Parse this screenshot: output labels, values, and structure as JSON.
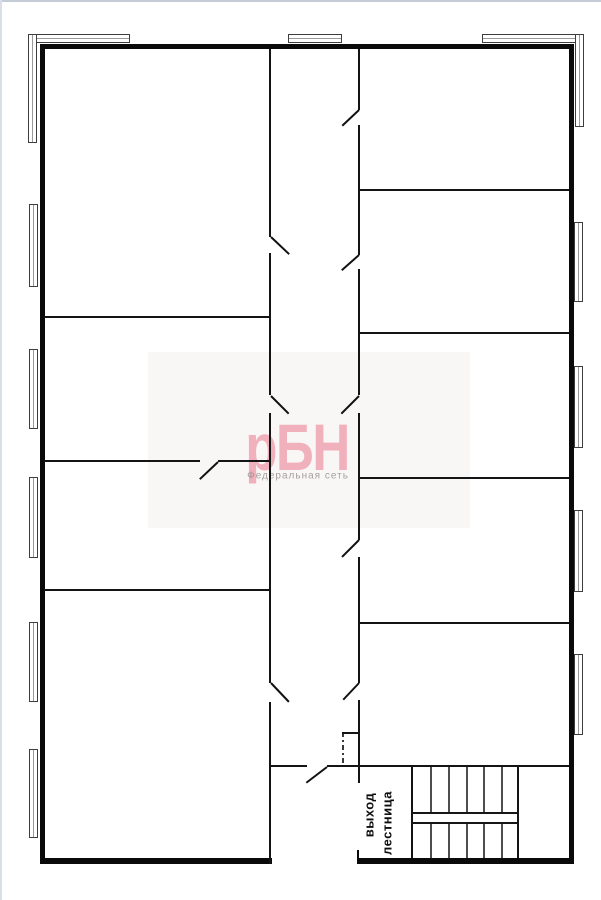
{
  "labels": {
    "exit": "выход",
    "stairs": "лестница"
  },
  "watermark": {
    "brand": "рБН",
    "subtitle": "Федеральная сеть",
    "brand_color": "#efa4b2",
    "subtitle_color": "#949091"
  },
  "colors": {
    "wall": "#0a0a0a",
    "thin_wall": "#141414",
    "step": "#4e4e4e",
    "window_frame": "#3e3e3e",
    "chrome_edge": "#c6ccd7"
  },
  "plan": {
    "width": 601,
    "height": 900,
    "walls_thick": [
      {
        "x": 41,
        "y": 44,
        "w": 533,
        "h": 5
      },
      {
        "x": 40,
        "y": 44,
        "w": 5,
        "h": 820
      },
      {
        "x": 569,
        "y": 44,
        "w": 5,
        "h": 820
      },
      {
        "x": 40,
        "y": 858,
        "w": 232,
        "h": 6
      },
      {
        "x": 357,
        "y": 858,
        "w": 217,
        "h": 6
      },
      {
        "x": 357,
        "y": 850,
        "w": 2,
        "h": 8
      }
    ],
    "walls_thin": [
      {
        "x": 269,
        "y": 49,
        "w": 2,
        "h": 188
      },
      {
        "x": 269,
        "y": 253,
        "w": 2,
        "h": 142
      },
      {
        "x": 269,
        "y": 413,
        "w": 2,
        "h": 270
      },
      {
        "x": 269,
        "y": 702,
        "w": 2,
        "h": 162
      },
      {
        "x": 358,
        "y": 49,
        "w": 2,
        "h": 61
      },
      {
        "x": 358,
        "y": 125,
        "w": 2,
        "h": 130
      },
      {
        "x": 358,
        "y": 269,
        "w": 2,
        "h": 126
      },
      {
        "x": 358,
        "y": 413,
        "w": 2,
        "h": 127
      },
      {
        "x": 358,
        "y": 557,
        "w": 2,
        "h": 126
      },
      {
        "x": 358,
        "y": 700,
        "w": 2,
        "h": 83
      },
      {
        "x": 44,
        "y": 316,
        "w": 225,
        "h": 2
      },
      {
        "x": 44,
        "y": 460,
        "w": 156,
        "h": 2
      },
      {
        "x": 218,
        "y": 460,
        "w": 51,
        "h": 2
      },
      {
        "x": 44,
        "y": 589,
        "w": 225,
        "h": 2
      },
      {
        "x": 360,
        "y": 189,
        "w": 209,
        "h": 2
      },
      {
        "x": 360,
        "y": 332,
        "w": 209,
        "h": 2
      },
      {
        "x": 360,
        "y": 477,
        "w": 209,
        "h": 2
      },
      {
        "x": 360,
        "y": 622,
        "w": 209,
        "h": 2
      },
      {
        "x": 271,
        "y": 765,
        "w": 36,
        "h": 2
      },
      {
        "x": 327,
        "y": 765,
        "w": 242,
        "h": 2
      },
      {
        "x": 411,
        "y": 766,
        "w": 2,
        "h": 92
      },
      {
        "x": 517,
        "y": 766,
        "w": 2,
        "h": 92
      },
      {
        "x": 342,
        "y": 732,
        "w": 17,
        "h": 2
      }
    ],
    "doors": [
      {
        "x1": 271,
        "y1": 237,
        "x2": 289,
        "y2": 254
      },
      {
        "x1": 271,
        "y1": 396,
        "x2": 289,
        "y2": 414
      },
      {
        "x1": 271,
        "y1": 683,
        "x2": 289,
        "y2": 702
      },
      {
        "x1": 359,
        "y1": 110,
        "x2": 342,
        "y2": 126
      },
      {
        "x1": 359,
        "y1": 255,
        "x2": 342,
        "y2": 270
      },
      {
        "x1": 359,
        "y1": 396,
        "x2": 341,
        "y2": 414
      },
      {
        "x1": 359,
        "y1": 540,
        "x2": 342,
        "y2": 557
      },
      {
        "x1": 359,
        "y1": 683,
        "x2": 343,
        "y2": 700
      },
      {
        "x1": 218,
        "y1": 462,
        "x2": 200,
        "y2": 479
      },
      {
        "x1": 327,
        "y1": 767,
        "x2": 306,
        "y2": 783
      }
    ],
    "windows_h": [
      {
        "x": 28,
        "y": 34,
        "w": 102,
        "h": 9
      },
      {
        "x": 288,
        "y": 34,
        "w": 54,
        "h": 9
      },
      {
        "x": 482,
        "y": 34,
        "w": 102,
        "h": 9
      }
    ],
    "windows_v": [
      {
        "x": 28,
        "y": 34,
        "w": 9,
        "h": 109
      },
      {
        "x": 575,
        "y": 34,
        "w": 9,
        "h": 93
      },
      {
        "x": 29,
        "y": 204,
        "w": 9,
        "h": 83
      },
      {
        "x": 29,
        "y": 349,
        "w": 9,
        "h": 80
      },
      {
        "x": 29,
        "y": 477,
        "w": 9,
        "h": 81
      },
      {
        "x": 29,
        "y": 622,
        "w": 9,
        "h": 80
      },
      {
        "x": 29,
        "y": 749,
        "w": 9,
        "h": 89
      },
      {
        "x": 574,
        "y": 222,
        "w": 9,
        "h": 80
      },
      {
        "x": 574,
        "y": 366,
        "w": 9,
        "h": 82
      },
      {
        "x": 574,
        "y": 510,
        "w": 9,
        "h": 82
      },
      {
        "x": 574,
        "y": 654,
        "w": 9,
        "h": 81
      }
    ],
    "dashdot": {
      "x": 342,
      "y": 732,
      "h": 34
    },
    "stairs": {
      "x": 413,
      "y": 766,
      "w": 104,
      "h": 92,
      "steps": [
        17,
        35,
        53,
        70,
        88
      ]
    }
  }
}
